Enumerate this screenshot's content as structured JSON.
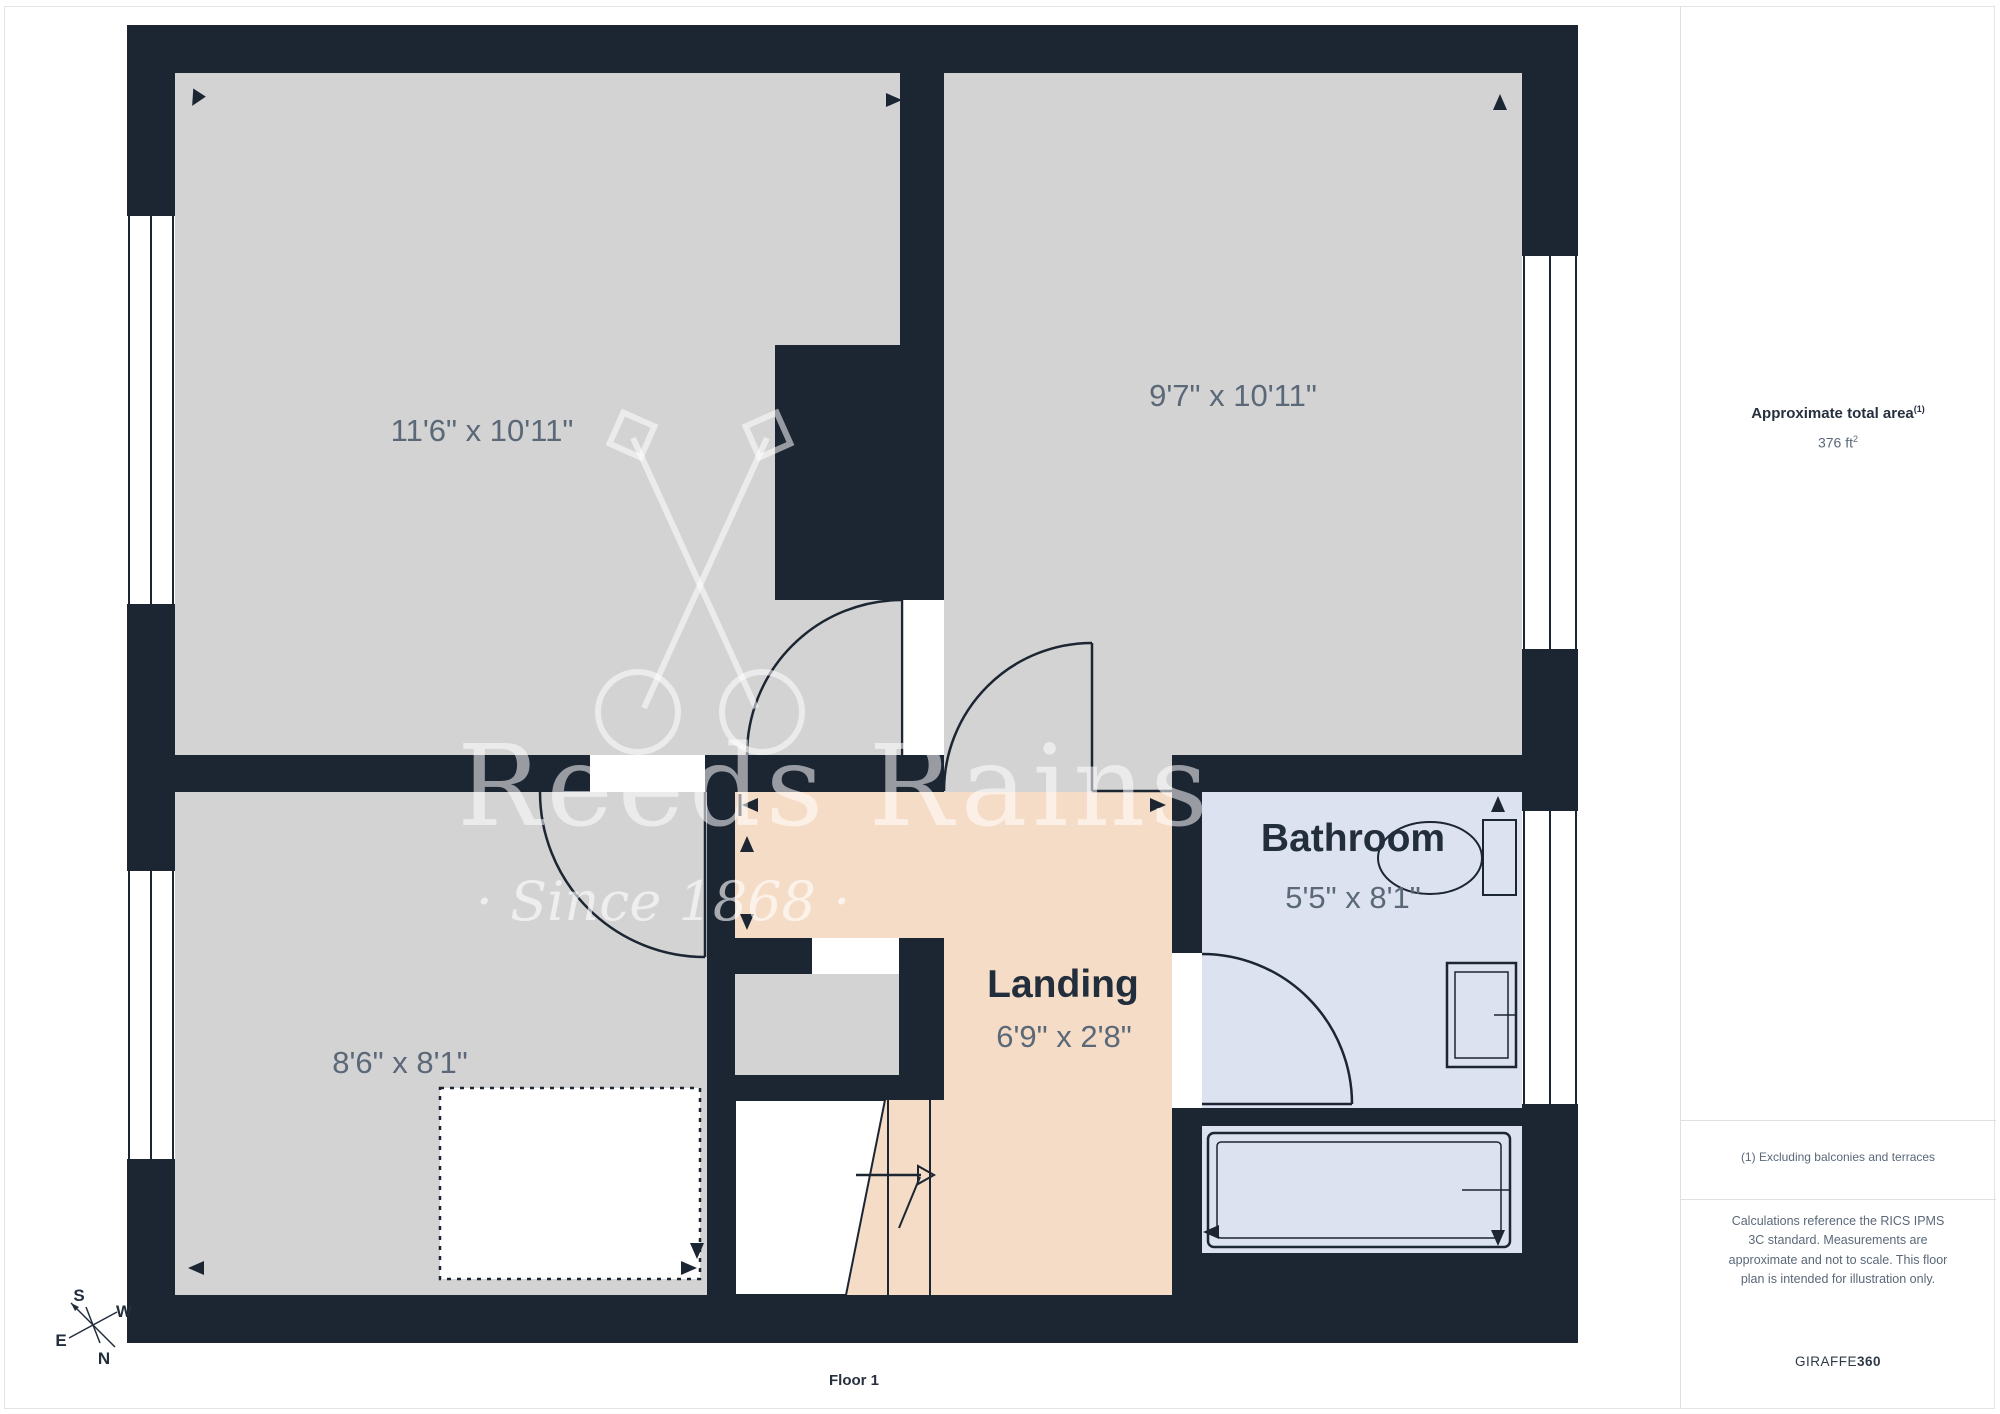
{
  "page": {
    "floor_label": "Floor 1"
  },
  "sidebar": {
    "area_title": "Approximate total area",
    "area_title_sup": "(1)",
    "area_value": "376 ft",
    "area_value_sup": "2",
    "note1": "(1) Excluding balconies and terraces",
    "disclaimer": "Calculations reference the RICS IPMS 3C standard. Measurements are approximate and not to scale. This floor plan is intended for illustration only.",
    "brand": "GIRAFFE",
    "brand_suffix": "360"
  },
  "rooms": {
    "top_left": {
      "dims": "11'6\" x 10'11\""
    },
    "top_right": {
      "dims": "9'7\" x 10'11\""
    },
    "bottom_left": {
      "dims": "8'6\" x 8'1\""
    },
    "bathroom": {
      "name": "Bathroom",
      "dims": "5'5\" x 8'1\""
    },
    "landing": {
      "name": "Landing",
      "dims": "6'9\" x 2'8\""
    }
  },
  "watermark": {
    "line1": "Reeds Rains",
    "line2": "· Since 1868 ·"
  },
  "compass": {
    "n": "N",
    "e": "E",
    "s": "S",
    "w": "W"
  },
  "colors": {
    "wall": "#1c2532",
    "room_gray": "#d3d3d3",
    "landing_peach": "#f5dcc7",
    "bathroom_blue": "#dce2ef",
    "label_slate": "#5a6878",
    "label_navy": "#232e3d"
  }
}
